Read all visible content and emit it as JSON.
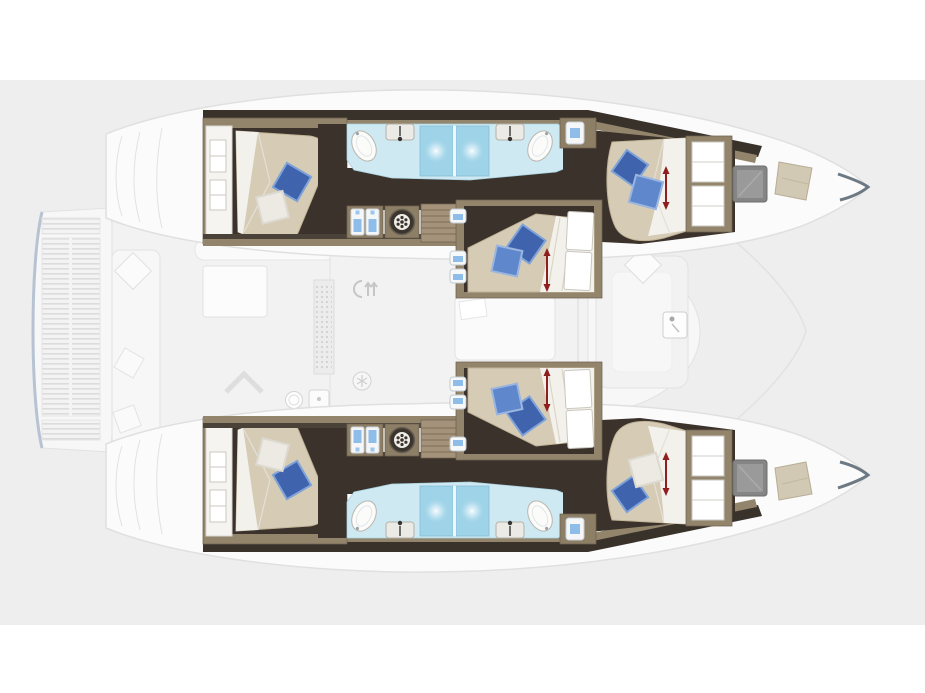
{
  "diagram": {
    "type": "catamaran-interior-deck-plan",
    "orientation": "bow-right",
    "hulls": [
      {
        "id": "port-hull",
        "position": "top",
        "areas": [
          "aft-double-cabin",
          "double-bathroom-with-two-showers",
          "corridor",
          "forward-double-cabin"
        ]
      },
      {
        "id": "starboard-hull",
        "position": "bottom",
        "areas": [
          "aft-double-cabin",
          "double-bathroom-with-two-showers",
          "corridor",
          "forward-double-cabin"
        ]
      }
    ],
    "midship_cabins": [
      "mid-cabin-upper",
      "mid-cabin-lower"
    ],
    "deck_areas": [
      "stern-platform",
      "teak-grating",
      "aft-cockpit",
      "cockpit-table",
      "saloon",
      "galley",
      "foredeck-lounge",
      "foredeck-seat"
    ],
    "icons": [
      "washing-machine-icon",
      "wardrobe-shirt-icon",
      "porthole-icon",
      "shower-icon",
      "sink-icon",
      "toilet-icon",
      "deck-hatch-icon",
      "skylight-icon",
      "dimension-arrow-icon",
      "windlass-icon",
      "cooler-icon",
      "snowflake-icon",
      "galley-sink-icon",
      "stove-icon",
      "cabin-door-icon",
      "companionway-chevron"
    ],
    "counts": {
      "double_cabins": 6,
      "showers": 4,
      "sinks": 4,
      "toilets": 4,
      "washing_machines": 2
    },
    "colors": {
      "pageBg": "#ffffff",
      "panelBg": "#eeeeee",
      "deckFill": "#f2f2f2",
      "deckSoft": "#f7f7f7",
      "deckStroke": "#e2e2e2",
      "hullFill": "#fbfbfb",
      "hullStroke": "#e0e0e0",
      "floorDark": "#3a322b",
      "wallDark": "#38322b",
      "wood": "#93846c",
      "woodLight": "#a4937a",
      "woodMid": "#8d7e66",
      "woodDark": "#6f6250",
      "mattress": "#d6cbb5",
      "mattressEdge": "#c0b296",
      "sheet": "#f3f1ec",
      "pillowBlue": "#3f63ad",
      "pillowBlueMid": "#5f87cb",
      "pillowBlueLight": "#7fa3d8",
      "pillowWhite": "#eceae3",
      "bathFloor": "#cfe9f2",
      "bathStroke": "#a9cfdd",
      "shower": "#9fd3e8",
      "fixtureWhite": "#fbfbfa",
      "fixtureStroke": "#b9b6ae",
      "accentRed": "#8f1f1f",
      "hatchGrey": "#858585",
      "skylight": "#d2c9b4",
      "teakLine": "#dcdcdc",
      "platformEdge": "#b7c3d2",
      "iconBlue": "#8fbde9"
    }
  }
}
